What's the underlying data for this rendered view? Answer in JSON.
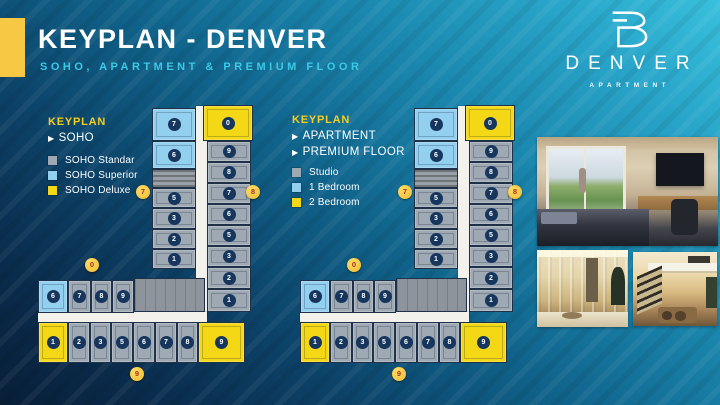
{
  "header": {
    "title": "KEYPLAN - DENVER",
    "subtitle": "SOHO, APARTMENT & PREMIUM FLOOR"
  },
  "logo": {
    "name": "DENVER",
    "tagline": "APARTMENT"
  },
  "legends": {
    "soho": {
      "heading": "KEYPLAN",
      "nav": [
        "SOHO"
      ],
      "swatches": [
        {
          "label": "SOHO Standar",
          "color": "#9EA9B3"
        },
        {
          "label": "SOHO Superior",
          "color": "#93CFEE"
        },
        {
          "label": "SOHO Deluxe",
          "color": "#F4D816"
        }
      ]
    },
    "apartment": {
      "heading": "KEYPLAN",
      "nav": [
        "APARTMENT",
        "PREMIUM FLOOR"
      ],
      "swatches": [
        {
          "label": "Studio",
          "color": "#9EA9B3"
        },
        {
          "label": "1 Bedroom",
          "color": "#93CFEE"
        },
        {
          "label": "2 Bedroom",
          "color": "#F4D816"
        }
      ]
    }
  },
  "floorplans": [
    {
      "id": "soho",
      "markers": {
        "left": "7",
        "right": "8",
        "top": "0",
        "bottom": "9"
      },
      "units": {
        "vertical_left": [
          {
            "no": "7",
            "type": "superior"
          },
          {
            "no": "6",
            "type": "superior"
          },
          {
            "no": "5",
            "type": "standar"
          },
          {
            "no": "3",
            "type": "standar"
          },
          {
            "no": "2",
            "type": "standar"
          },
          {
            "no": "1",
            "type": "standar"
          }
        ],
        "vertical_right": [
          {
            "no": "0",
            "type": "deluxe"
          },
          {
            "no": "9",
            "type": "standar"
          },
          {
            "no": "8",
            "type": "standar"
          },
          {
            "no": "7",
            "type": "standar"
          },
          {
            "no": "6",
            "type": "standar"
          },
          {
            "no": "5",
            "type": "standar"
          },
          {
            "no": "3",
            "type": "standar"
          },
          {
            "no": "2",
            "type": "standar"
          },
          {
            "no": "1",
            "type": "standar"
          }
        ],
        "top_row": [
          {
            "no": "6",
            "type": "superior"
          },
          {
            "no": "7",
            "type": "standar"
          },
          {
            "no": "8",
            "type": "standar"
          },
          {
            "no": "9",
            "type": "standar"
          }
        ],
        "bottom_row": [
          {
            "no": "1",
            "type": "deluxe"
          },
          {
            "no": "2",
            "type": "standar"
          },
          {
            "no": "3",
            "type": "standar"
          },
          {
            "no": "5",
            "type": "standar"
          },
          {
            "no": "6",
            "type": "standar"
          },
          {
            "no": "7",
            "type": "standar"
          },
          {
            "no": "8",
            "type": "standar"
          },
          {
            "no": "9",
            "type": "deluxe"
          }
        ]
      }
    },
    {
      "id": "apartment",
      "markers": {
        "left": "7",
        "right": "8",
        "top": "0",
        "bottom": "9"
      },
      "units": {
        "vertical_left": [
          {
            "no": "7",
            "type": "1br"
          },
          {
            "no": "6",
            "type": "1br"
          },
          {
            "no": "5",
            "type": "studio"
          },
          {
            "no": "3",
            "type": "studio"
          },
          {
            "no": "2",
            "type": "studio"
          },
          {
            "no": "1",
            "type": "studio"
          }
        ],
        "vertical_right": [
          {
            "no": "0",
            "type": "2br"
          },
          {
            "no": "9",
            "type": "studio"
          },
          {
            "no": "8",
            "type": "studio"
          },
          {
            "no": "7",
            "type": "studio"
          },
          {
            "no": "6",
            "type": "studio"
          },
          {
            "no": "5",
            "type": "studio"
          },
          {
            "no": "3",
            "type": "studio"
          },
          {
            "no": "2",
            "type": "studio"
          },
          {
            "no": "1",
            "type": "studio"
          }
        ],
        "top_row": [
          {
            "no": "6",
            "type": "1br"
          },
          {
            "no": "7",
            "type": "studio"
          },
          {
            "no": "8",
            "type": "studio"
          },
          {
            "no": "9",
            "type": "studio"
          }
        ],
        "bottom_row": [
          {
            "no": "1",
            "type": "2br"
          },
          {
            "no": "2",
            "type": "studio"
          },
          {
            "no": "3",
            "type": "studio"
          },
          {
            "no": "5",
            "type": "studio"
          },
          {
            "no": "6",
            "type": "studio"
          },
          {
            "no": "7",
            "type": "studio"
          },
          {
            "no": "8",
            "type": "studio"
          },
          {
            "no": "9",
            "type": "2br"
          }
        ]
      }
    }
  ],
  "photos": [
    {
      "name": "bedroom-with-workspace"
    },
    {
      "name": "entry-hallway"
    },
    {
      "name": "loft-living-room"
    }
  ],
  "colors": {
    "accent_yellow": "#F7C843",
    "legend_yellow": "#F5CE1D",
    "subtitle_cyan": "#3BCAE4",
    "unit_gray": "#9EA9B3",
    "unit_blue": "#93CFEE",
    "unit_yellow": "#F4D816",
    "badge_navy": "#16365E",
    "marker_number_red": "#A03226",
    "bg_dark": "#081F38",
    "bg_light": "#38C0DC"
  }
}
